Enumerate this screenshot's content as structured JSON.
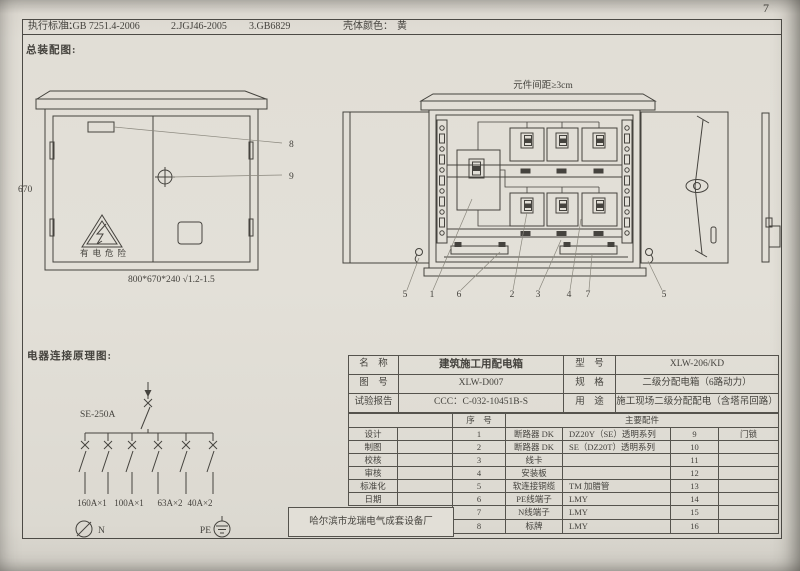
{
  "page": {
    "number": "7"
  },
  "header": {
    "standards_label": "执行标准：",
    "standards": [
      "1.GB 7251.4-2006",
      "2.JGJ46-2005",
      "3.GB6829"
    ],
    "shell_color_label": "壳体颜色：",
    "shell_color": "黄"
  },
  "assembly": {
    "section_title": "总装配图:",
    "closed_view": {
      "height_dim": "670",
      "bottom_dim": "800*670*240  √1.2-1.5",
      "warning_text": "有电危险",
      "callout_8": "8",
      "callout_9": "9"
    },
    "open_view": {
      "clearance_note": "元件间距≥3cm",
      "callouts": [
        "5",
        "1",
        "6",
        "2",
        "3",
        "4",
        "7",
        "5"
      ]
    }
  },
  "schematic": {
    "section_title": "电器连接原理图:",
    "main_breaker": "SE-250A",
    "branch_ratings": [
      "160A×1",
      "100A×1",
      "63A×2",
      "40A×2"
    ],
    "neutral_label": "N",
    "pe_label": "PE"
  },
  "info_table": {
    "rows_top": [
      {
        "label": "名　称",
        "value": "建筑施工用配电箱",
        "label2": "型　号",
        "value2": "XLW-206/KD"
      },
      {
        "label": "图　号",
        "value": "XLW-D007",
        "label2": "规　格",
        "value2": "二级分配电箱（6路动力）"
      },
      {
        "label": "试验报告",
        "value": "CCC：C-032-10451B-S",
        "label2": "用　途",
        "value2": "施工现场二级分配配电（含塔吊回路）"
      }
    ],
    "header_row": {
      "seq": "序　号",
      "parts": "主要配件"
    },
    "rows": [
      {
        "label": "设计",
        "sig": "",
        "no": "1",
        "part": "断路器 DK",
        "spec": "DZ20Y（SE）透明系列",
        "no2": "9",
        "part2": "门锁"
      },
      {
        "label": "制图",
        "sig": "",
        "no": "2",
        "part": "断路器 DK",
        "spec": "SE（DZ20T）透明系列",
        "no2": "10",
        "part2": ""
      },
      {
        "label": "校核",
        "sig": "",
        "no": "3",
        "part": "线卡",
        "spec": "",
        "no2": "11",
        "part2": ""
      },
      {
        "label": "审核",
        "sig": "",
        "no": "4",
        "part": "安装板",
        "spec": "",
        "no2": "12",
        "part2": ""
      },
      {
        "label": "标准化",
        "sig": "",
        "no": "5",
        "part": "软连接铜缆",
        "spec": "TM 加腊管",
        "no2": "13",
        "part2": ""
      },
      {
        "label": "日期",
        "sig": "",
        "no": "6",
        "part": "PE线端子",
        "spec": "LMY",
        "no2": "14",
        "part2": ""
      },
      {
        "label": "",
        "sig": "",
        "no": "7",
        "part": "N线端子",
        "spec": "LMY",
        "no2": "15",
        "part2": ""
      },
      {
        "label": "",
        "sig": "",
        "no": "8",
        "part": "标牌",
        "spec": "LMY",
        "no2": "16",
        "part2": ""
      }
    ],
    "manufacturer": "哈尔滨市龙瑞电气成套设备厂"
  }
}
